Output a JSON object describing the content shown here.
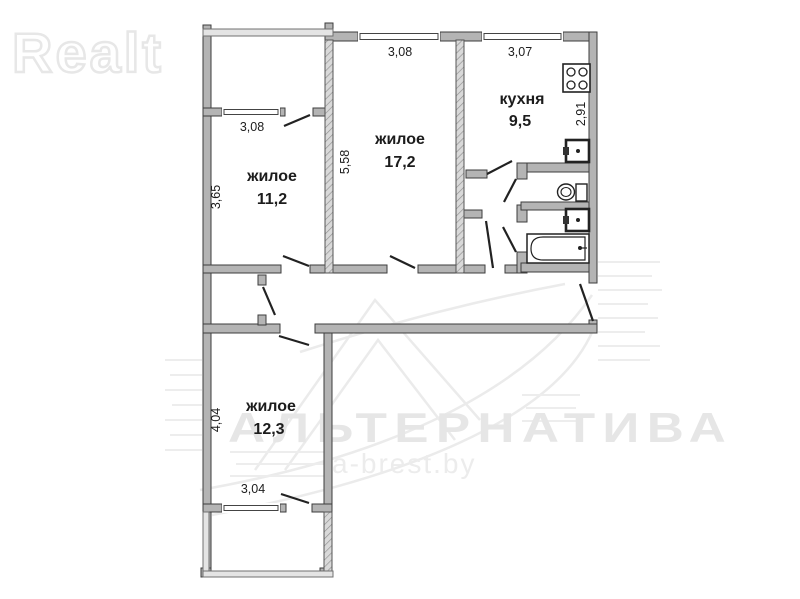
{
  "watermarks": {
    "brand": "Realt",
    "agency": "АЛЬТЕРНАТИВА",
    "site": "a-brest.by"
  },
  "plan": {
    "type": "apartment-floor-plan",
    "rooms": [
      {
        "name": "living-room-1",
        "label": "жилое",
        "area": "11,2",
        "dim_w": "3,08",
        "dim_h": "3,65"
      },
      {
        "name": "living-room-2",
        "label": "жилое",
        "area": "17,2",
        "dim_w": "3,08",
        "dim_h": "5,58"
      },
      {
        "name": "kitchen",
        "label": "кухня",
        "area": "9,5",
        "dim_w": "3,07",
        "dim_h": "2,91"
      },
      {
        "name": "living-room-3",
        "label": "жилое",
        "area": "12,3",
        "dim_w": "3,04",
        "dim_h": "4,04"
      }
    ],
    "colors": {
      "wall_fill": "#b4b4b4",
      "wall_stroke": "#3d3d3d",
      "fixture_stroke": "#222222",
      "watermark": "#e6e6e6",
      "background": "#ffffff"
    }
  }
}
